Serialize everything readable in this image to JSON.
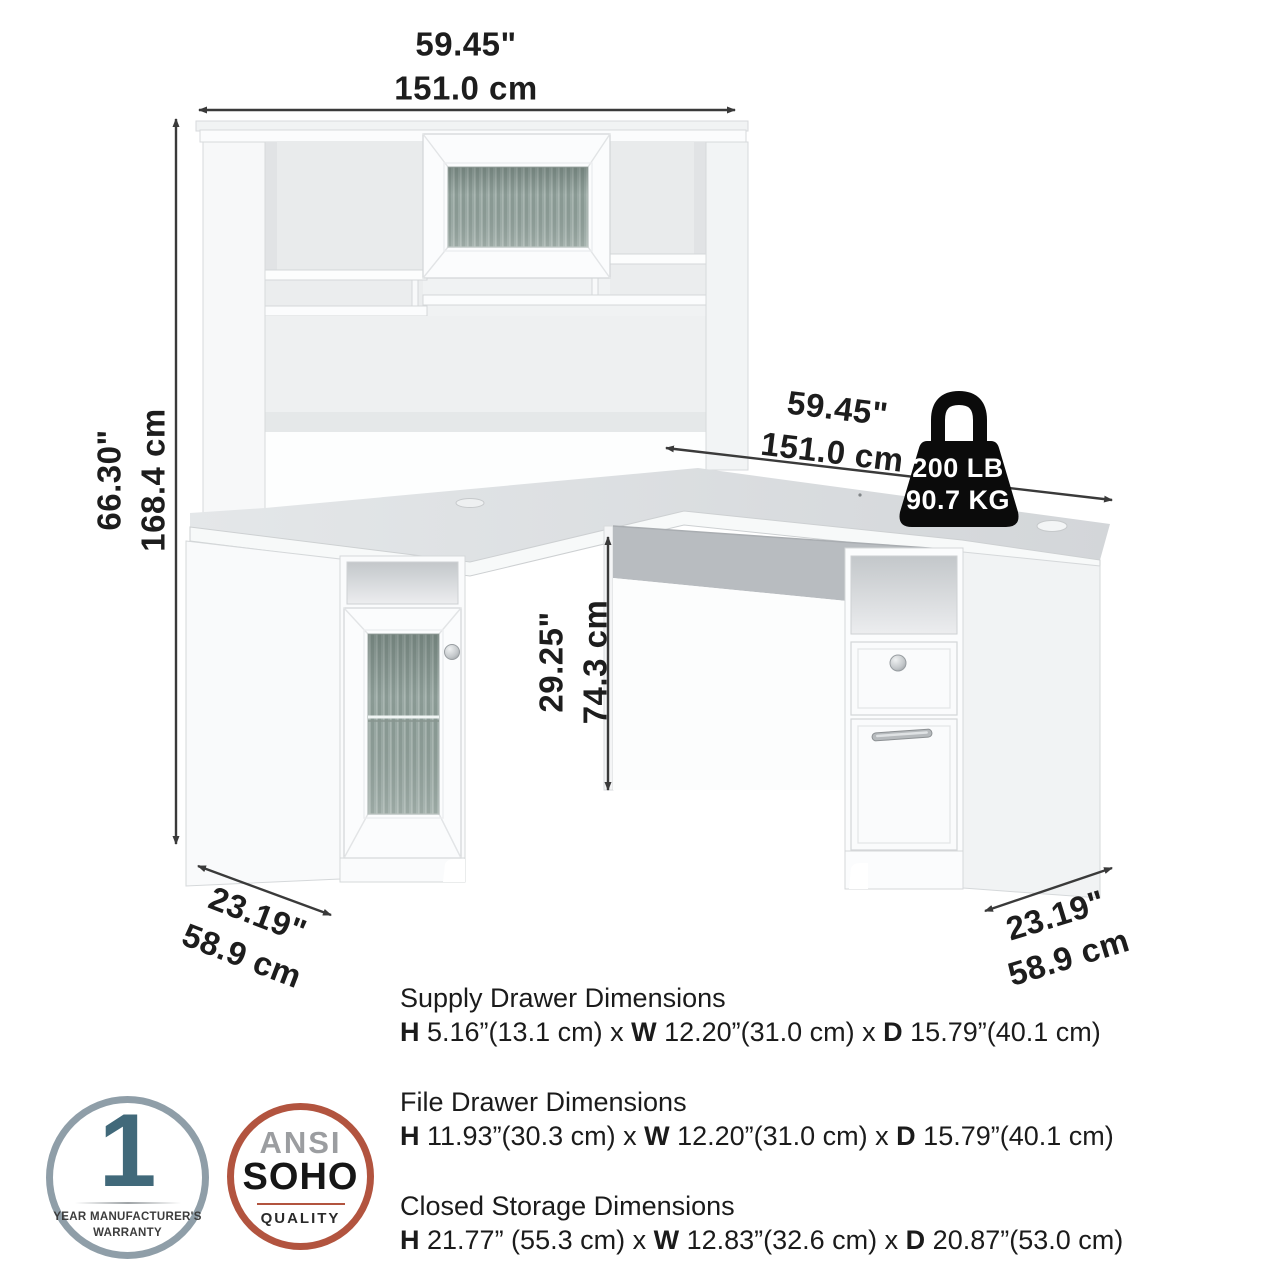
{
  "colors": {
    "arrow": "#3a3a3a",
    "frosted_glass": "#94a49f",
    "desk_top": "#dadde0",
    "warranty_ring": "#8f9ea8",
    "warranty_number": "#41697a",
    "ansi_ring": "#b2543f",
    "ansi_gray": "#9b9da0",
    "weight_icon": "#0b0b0b"
  },
  "dim_labels": {
    "hutch_width": {
      "in": "59.45\"",
      "cm": "151.0 cm"
    },
    "overall_height": {
      "in": "66.30\"",
      "cm": "168.4 cm"
    },
    "desk_width": {
      "in": "59.45\"",
      "cm": "151.0 cm"
    },
    "desk_height": {
      "in": "29.25\"",
      "cm": "74.3 cm"
    },
    "left_depth": {
      "in": "23.19\"",
      "cm": "58.9 cm"
    },
    "right_depth": {
      "in": "23.19\"",
      "cm": "58.9 cm"
    }
  },
  "weight_capacity": {
    "lb": "200 LB",
    "kg": "90.7 KG"
  },
  "spec_sections": [
    {
      "title": "Supply Drawer Dimensions",
      "h_label": "H",
      "h_value": " 5.16”(13.1 cm) x ",
      "w_label": "W",
      "w_value": " 12.20”(31.0 cm) x ",
      "d_label": "D",
      "d_value": " 15.79”(40.1 cm)"
    },
    {
      "title": "File Drawer Dimensions",
      "h_label": "H",
      "h_value": " 11.93”(30.3 cm) x ",
      "w_label": "W",
      "w_value": " 12.20”(31.0 cm) x ",
      "d_label": "D",
      "d_value": " 15.79”(40.1 cm)"
    },
    {
      "title": "Closed Storage Dimensions",
      "h_label": "H",
      "h_value": " 21.77” (55.3 cm) x ",
      "w_label": "W",
      "w_value": "  12.83”(32.6 cm) x ",
      "d_label": "D",
      "d_value": " 20.87”(53.0 cm)"
    }
  ],
  "badges": {
    "warranty": {
      "number": "1",
      "line1": "YEAR MANUFACTURER'S",
      "line2": "WARRANTY"
    },
    "ansi": {
      "line1": "ANSI",
      "line2": "SOHO",
      "line3": "QUALITY"
    }
  }
}
